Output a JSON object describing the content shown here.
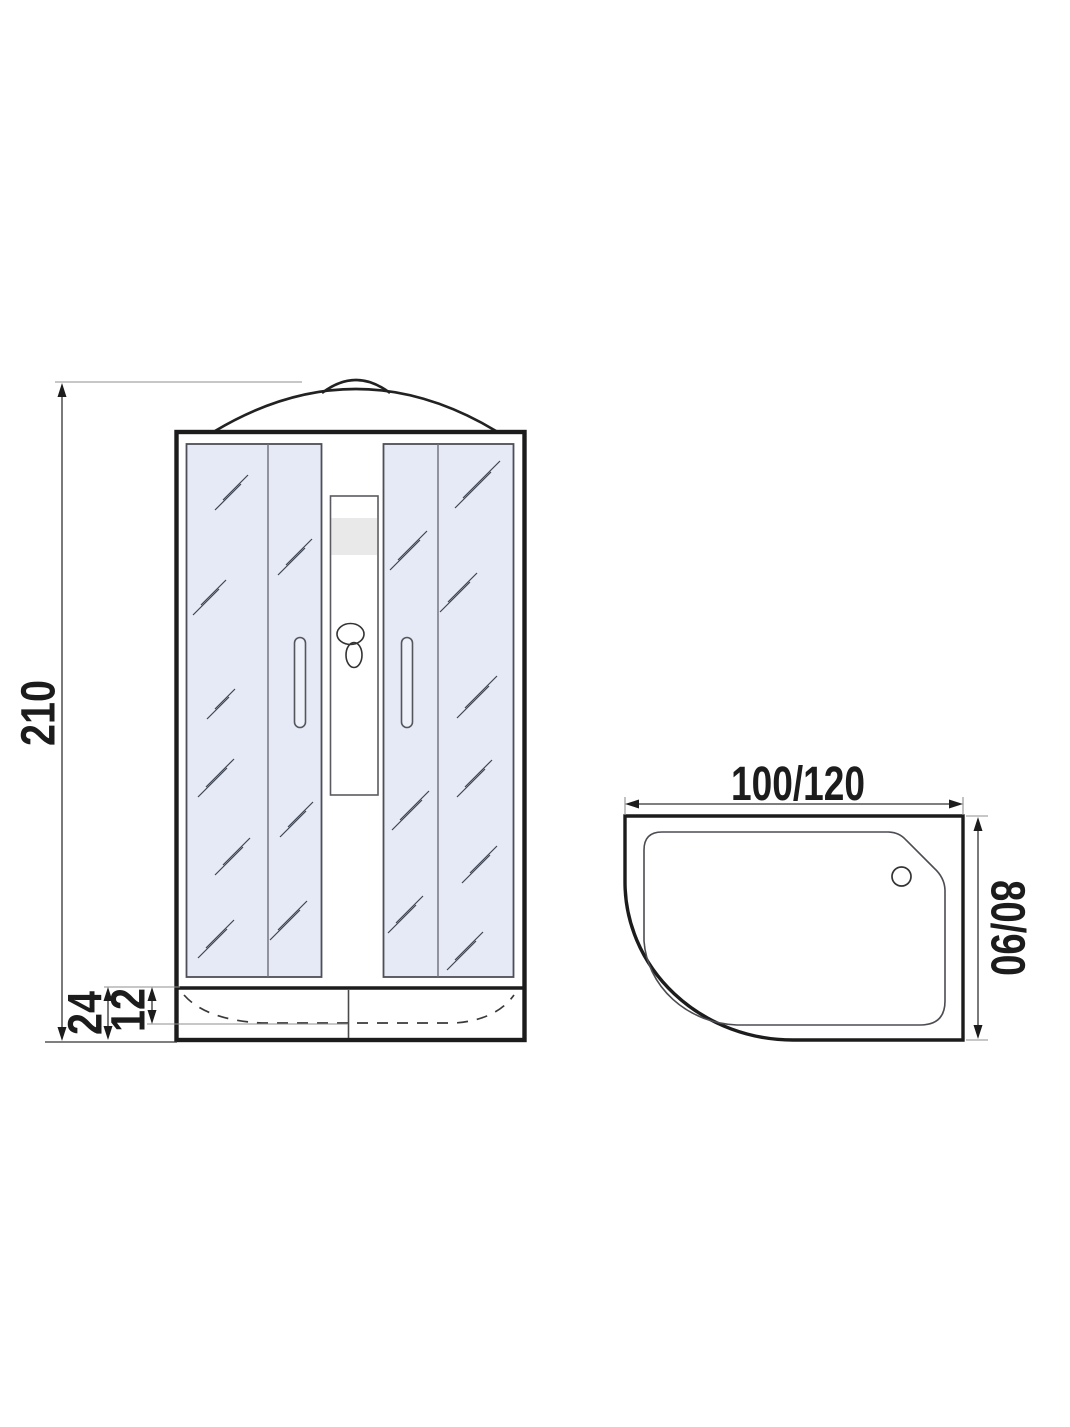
{
  "front_view": {
    "height_cm": "210",
    "tray_height_cm": "24",
    "tray_inner_depth_cm": "12"
  },
  "top_view": {
    "width_cm": "100/120",
    "depth_cm": "80/90"
  },
  "colors": {
    "glass_tint": "#e5eaf6",
    "outline": "#1c1c1c"
  }
}
